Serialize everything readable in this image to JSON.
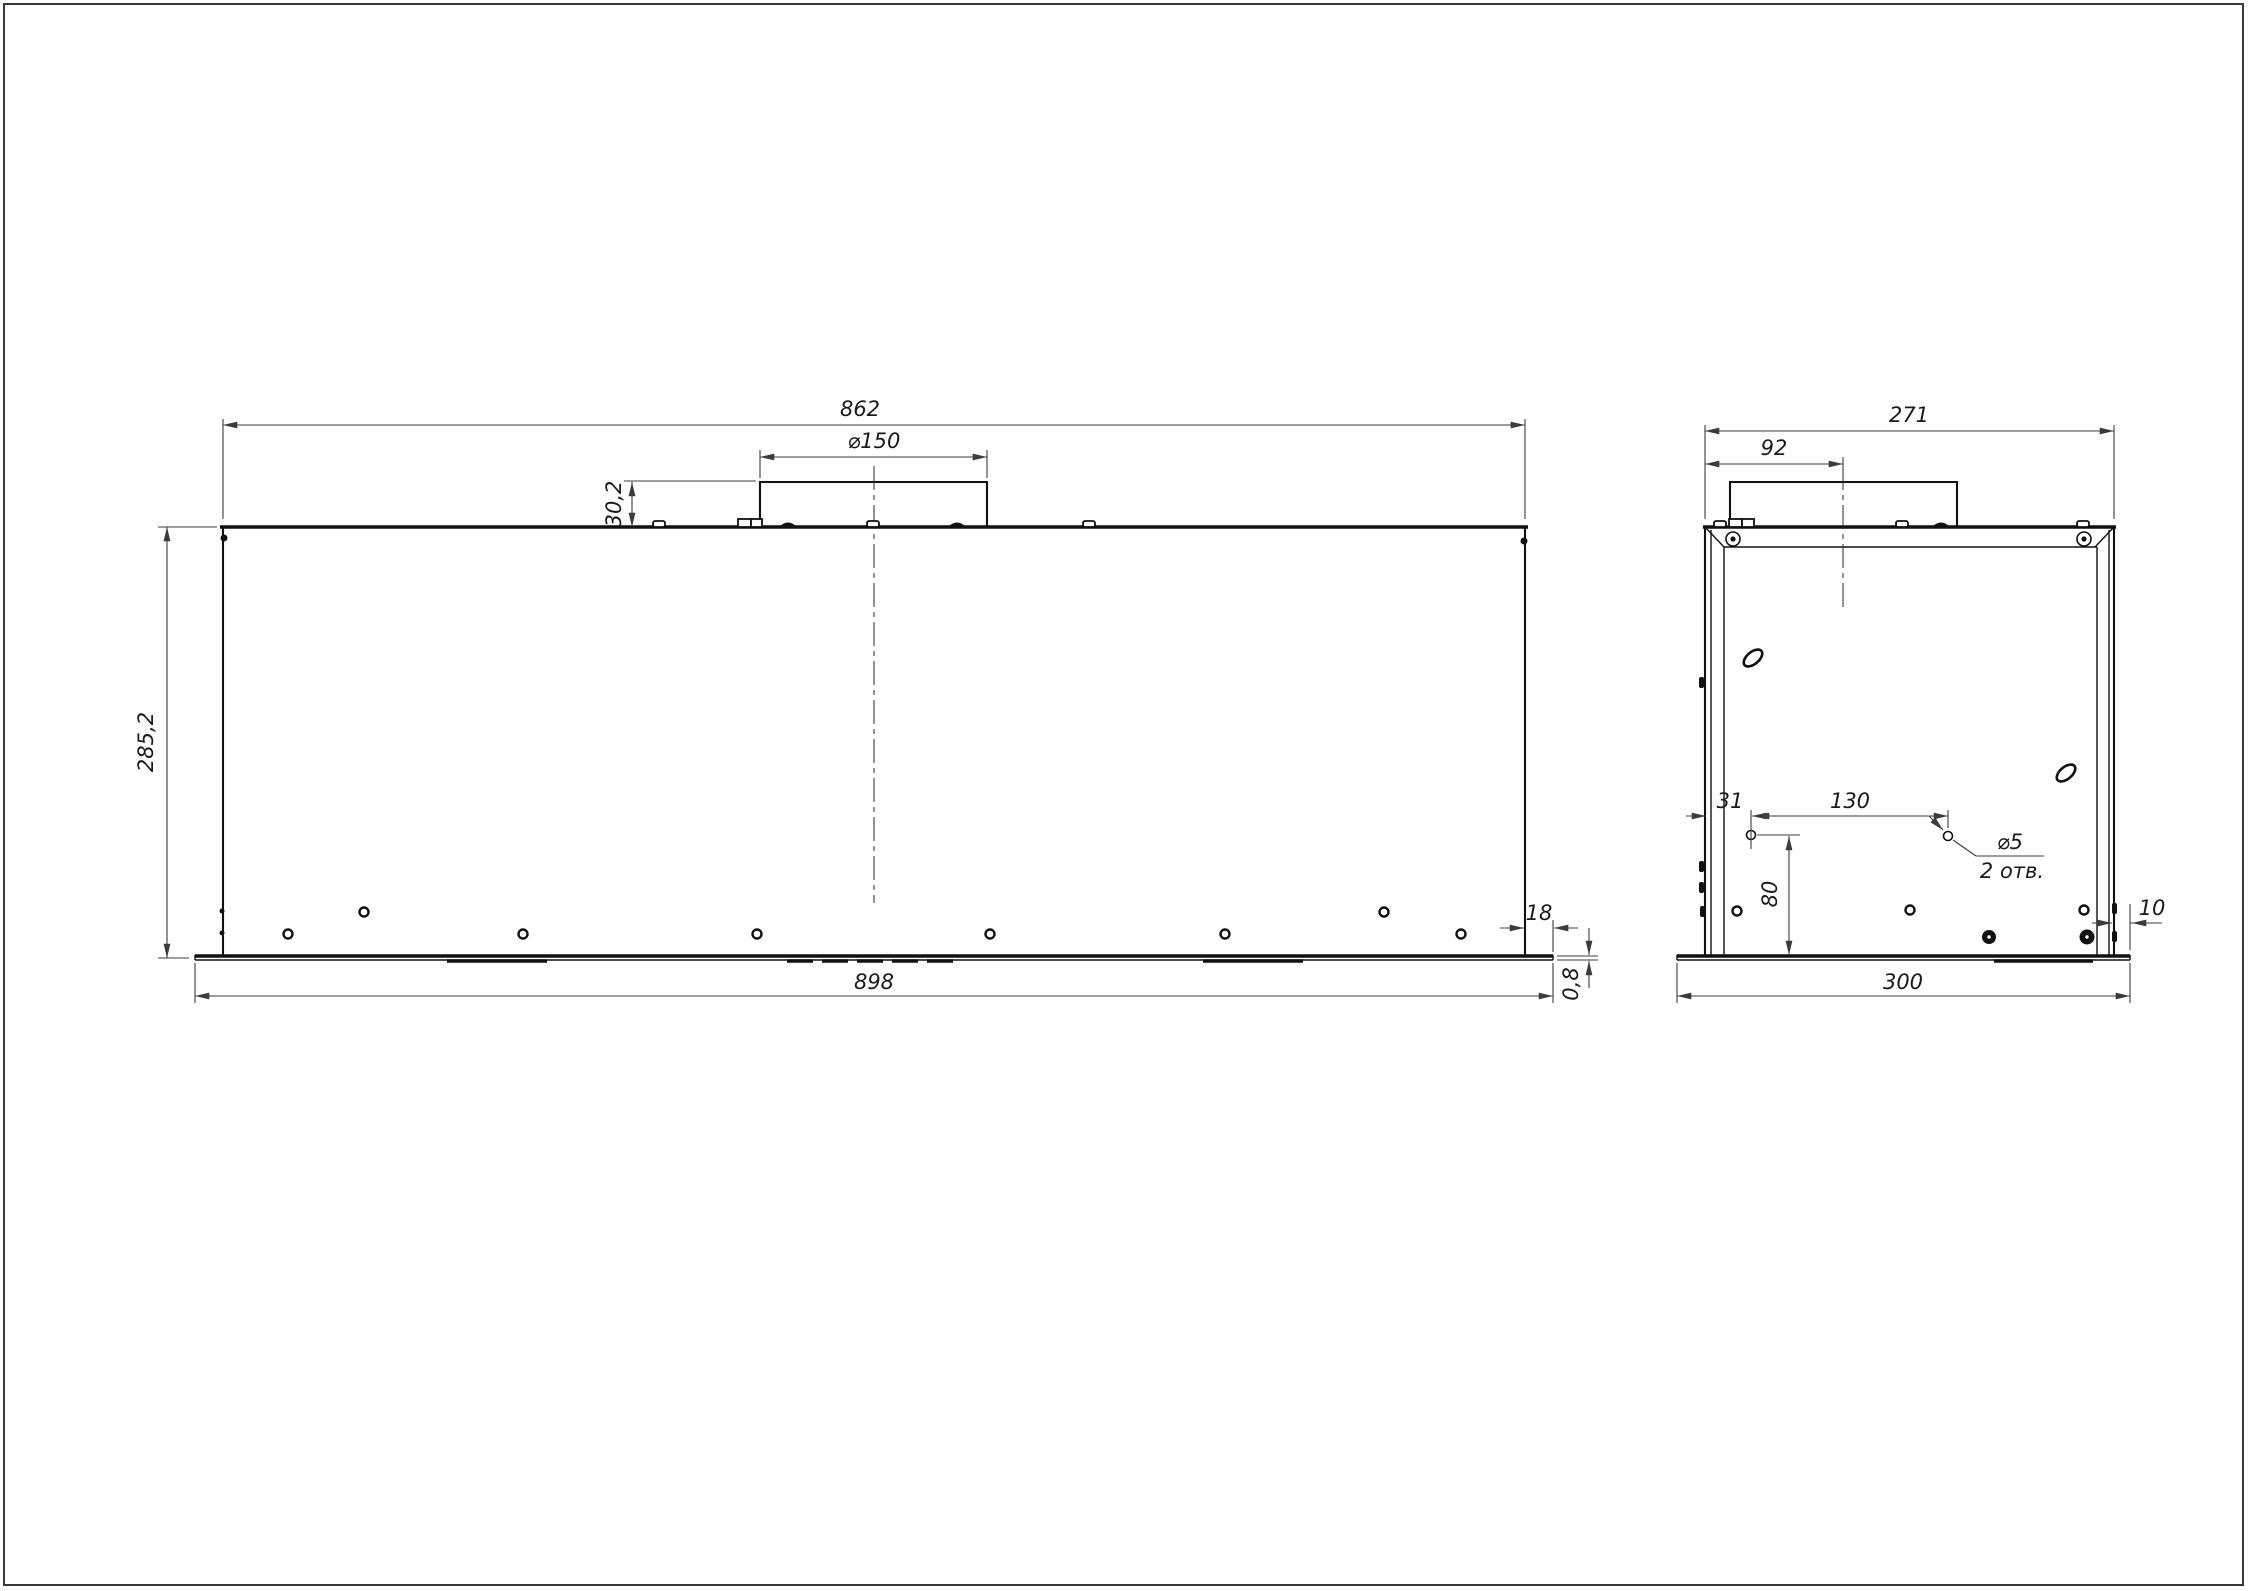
{
  "drawing": {
    "kind": "technical-drawing-two-views",
    "front": {
      "width_top": "862",
      "duct_diameter": "⌀150",
      "duct_height": "30,2",
      "height": "285,2",
      "flange_overhang": "18",
      "width_bottom": "898",
      "sheet_thickness": "0,8"
    },
    "side": {
      "depth_top": "271",
      "duct_offset": "92",
      "hole_offset_x": "31",
      "hole_spacing": "130",
      "hole_diameter": "⌀5",
      "hole_count": "2 отв.",
      "hole_offset_y": "80",
      "flange_overhang": "10",
      "depth_bottom": "300"
    },
    "colors": {
      "object_line": "#111111",
      "dimension_line": "#3c3c3c",
      "background": "#ffffff"
    }
  }
}
